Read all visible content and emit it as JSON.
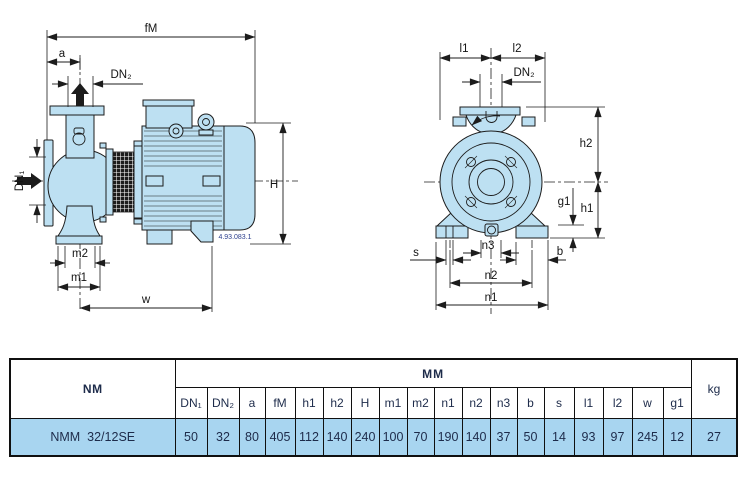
{
  "side_view": {
    "labels": {
      "fM": "fM",
      "a": "a",
      "dn2": "DN₂",
      "dn1": "DN₁",
      "m2": "m2",
      "m1": "m1",
      "w": "w",
      "H": "H"
    },
    "drawing_number": "4.93.083.1"
  },
  "front_view": {
    "labels": {
      "l1": "l1",
      "l2": "l2",
      "dn2": "DN₂",
      "h2": "h2",
      "h1": "h1",
      "g1": "g1",
      "s": "s",
      "n3": "n3",
      "b": "b",
      "n2": "n2",
      "n1": "n1"
    }
  },
  "table": {
    "series_label": "NM",
    "unit_header": "mm",
    "weight_header": "kg",
    "columns": [
      "DN₁",
      "DN₂",
      "a",
      "fM",
      "h1",
      "h2",
      "H",
      "m1",
      "m2",
      "n1",
      "n2",
      "n3",
      "b",
      "s",
      "l1",
      "l2",
      "w",
      "g1"
    ],
    "rows": [
      {
        "model": "NMM  32/12SE",
        "values": [
          "50",
          "32",
          "80",
          "405",
          "112",
          "140",
          "240",
          "100",
          "70",
          "190",
          "140",
          "37",
          "50",
          "14",
          "93",
          "97",
          "245",
          "12"
        ],
        "weight": "27"
      }
    ]
  },
  "colors": {
    "body_fill": "#bde0f2",
    "row_highlight": "#a8d5f0",
    "line": "#1c1c1c",
    "table_text": "#1d2b4a"
  }
}
